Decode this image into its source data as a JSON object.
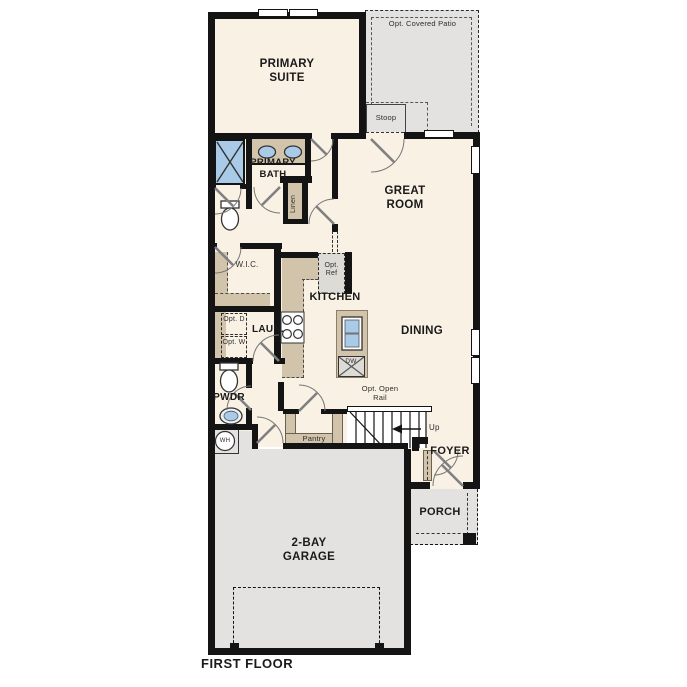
{
  "title": "FIRST FLOOR",
  "colors": {
    "floor": "#f8f1e4",
    "garage_porch_patio": "#e3e2e0",
    "cabinet_tan": "#d2c4ab",
    "fixture_blue": "#a9cbe8",
    "wall": "#141414"
  },
  "labels": {
    "patio": "Opt. Covered Patio",
    "stoop": "Stoop",
    "primary_suite": "PRIMARY SUITE",
    "great_room": "GREAT ROOM",
    "primary_bath": "PRIMARY BATH",
    "linen": "Linen",
    "wic": "W.I.C.",
    "opt_ref": "Opt. Ref",
    "kitchen": "KITCHEN",
    "dining": "DINING",
    "laundry": "LAUN.",
    "opt_dryer": "Opt. D",
    "opt_washer": "Opt. W",
    "powder": "PWDR",
    "water_heater": "WH",
    "dishwasher": "DW",
    "pantry": "Pantry",
    "opt_open_rail": "Opt. Open Rail",
    "stairs_up": "Up",
    "foyer": "FOYER",
    "porch": "PORCH",
    "garage": "2-BAY GARAGE"
  }
}
